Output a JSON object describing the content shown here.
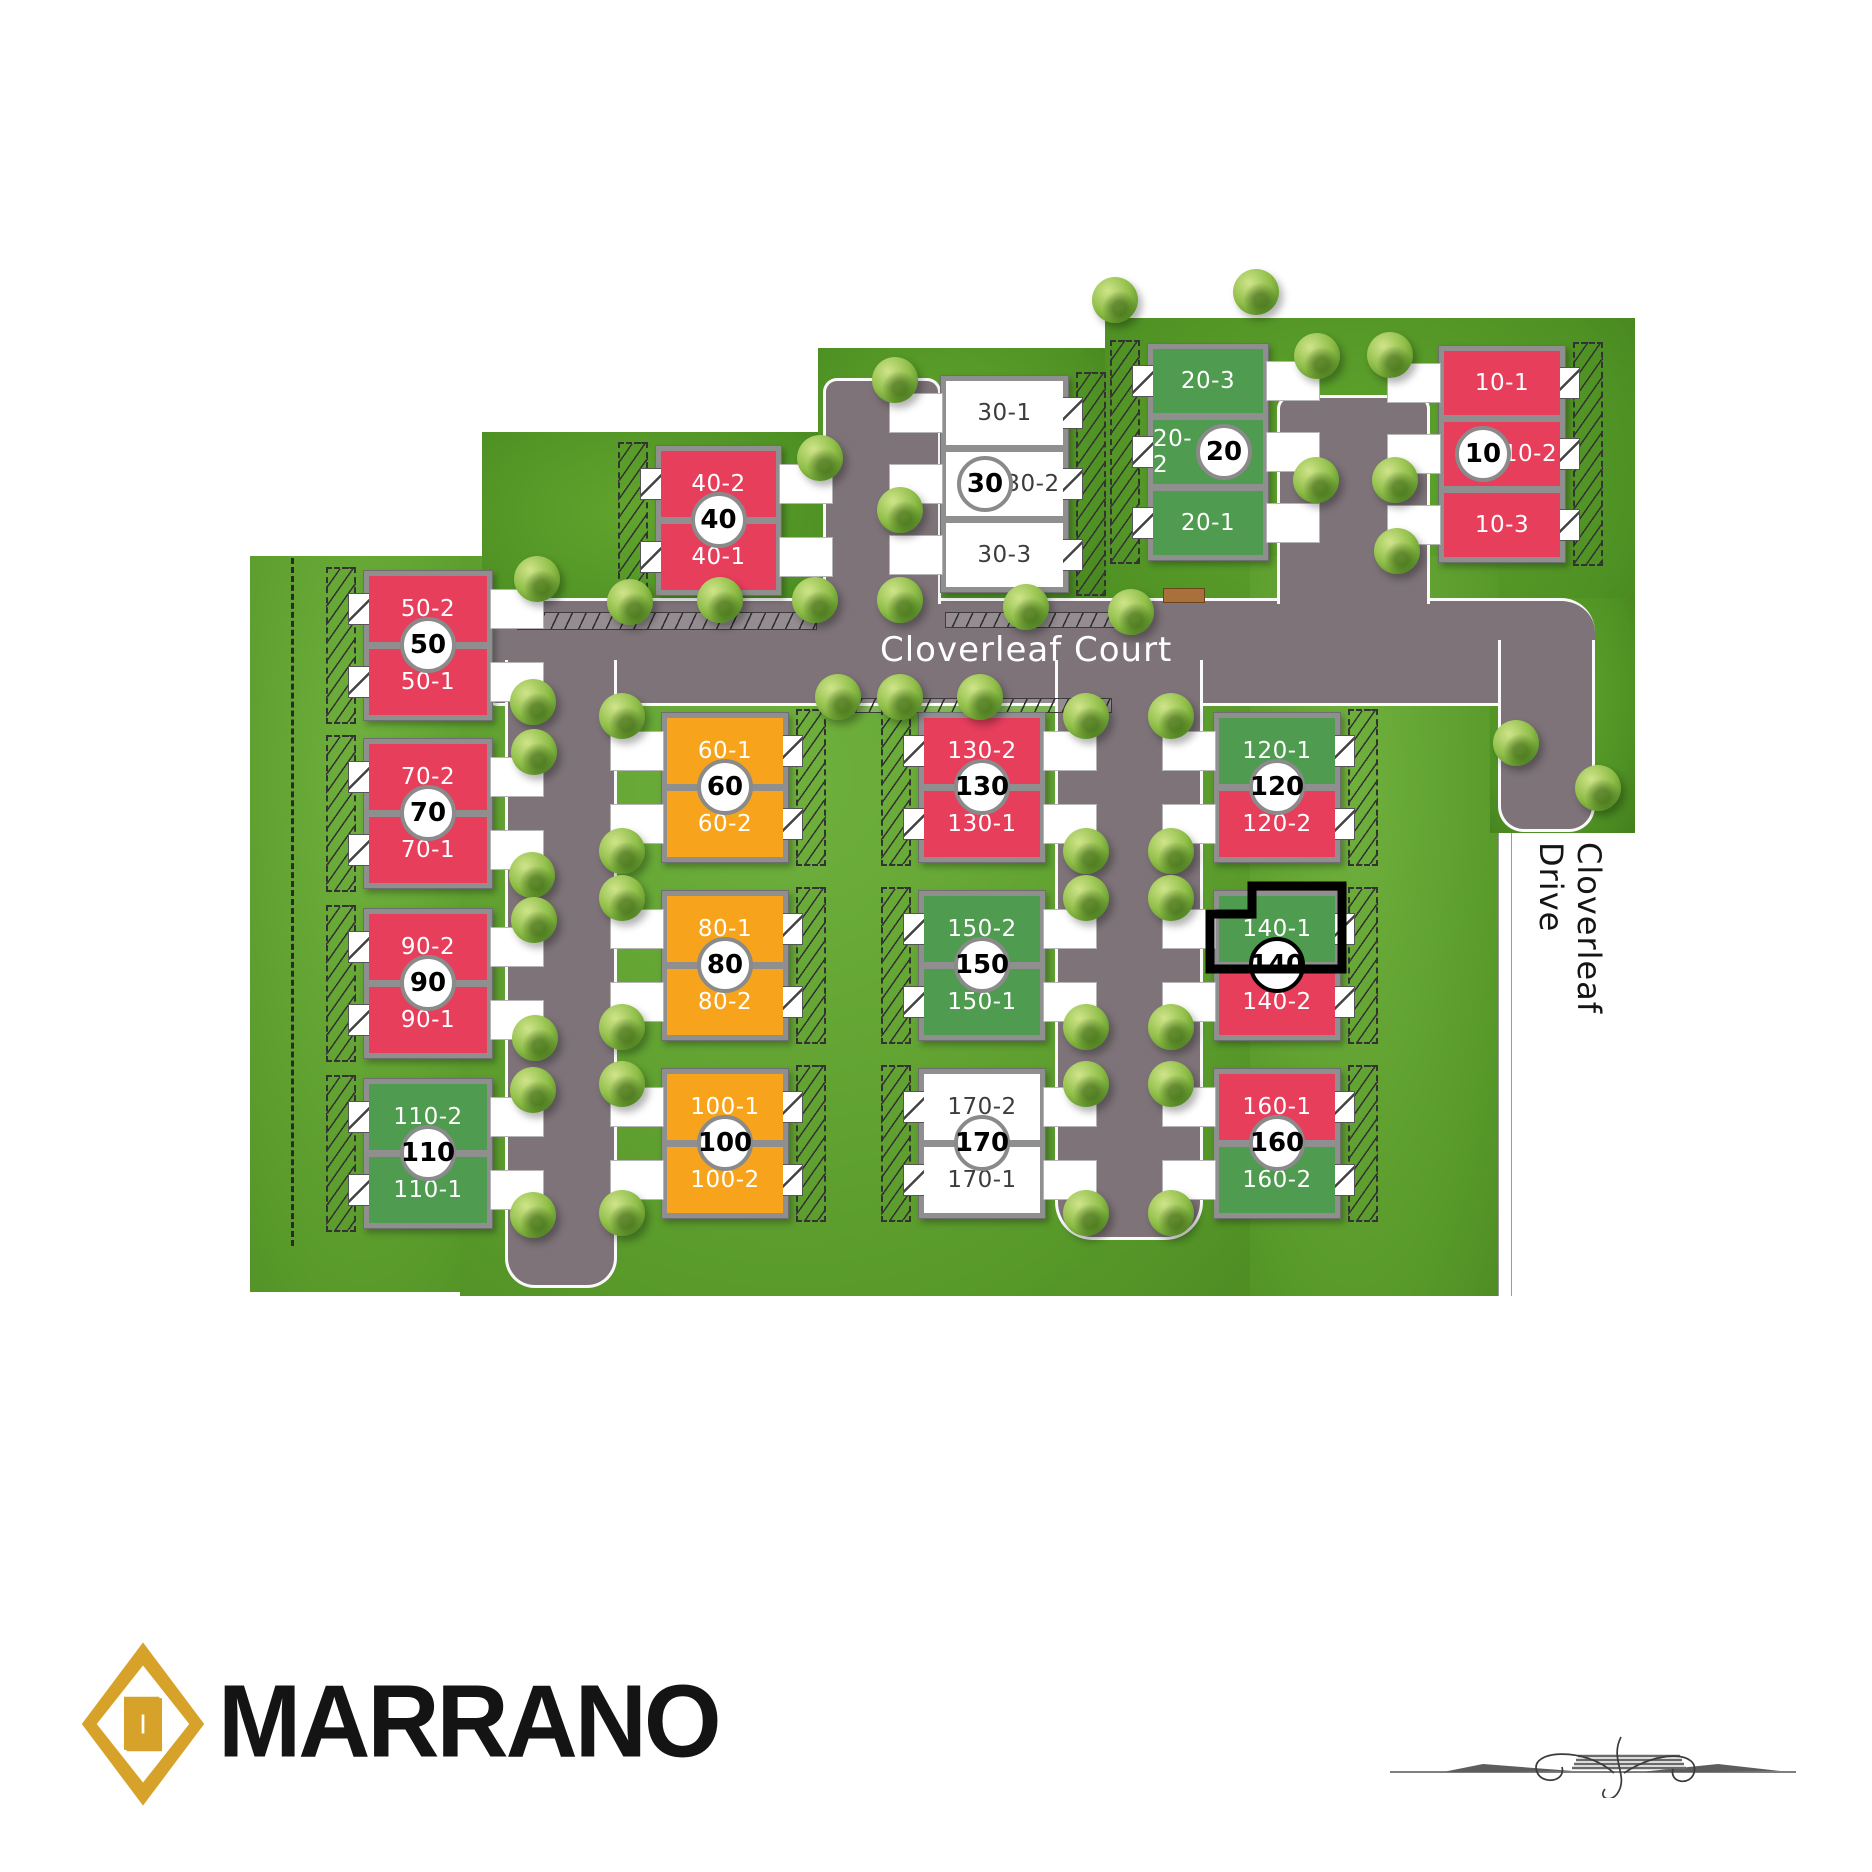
{
  "site": {
    "streets": {
      "court": "Cloverleaf Court",
      "drive": "Cloverleaf Drive"
    },
    "brand": {
      "wordmark": "MARRANO"
    },
    "highlighted_unit": "140-1",
    "colors": {
      "red": "#e73e5c",
      "green": "#4f9b4f",
      "orange": "#f7a41c",
      "white": "#ffffff",
      "road": "#7d7378",
      "grass": "#63a532",
      "brand_gold": "#d7a229"
    }
  },
  "buildings": [
    {
      "id": "10",
      "badge": "10",
      "x": 1438,
      "y": 345,
      "w": 126,
      "uh": 64,
      "garage": "W",
      "badge_side": "left",
      "units": [
        {
          "label": "10-1",
          "color": "red"
        },
        {
          "label": "10-2",
          "color": "red"
        },
        {
          "label": "10-3",
          "color": "red"
        }
      ]
    },
    {
      "id": "20",
      "badge": "20",
      "x": 1147,
      "y": 343,
      "w": 120,
      "uh": 64,
      "garage": "E",
      "badge_side": "right",
      "units": [
        {
          "label": "20-3",
          "color": "green"
        },
        {
          "label": "20-2",
          "color": "green"
        },
        {
          "label": "20-1",
          "color": "green"
        }
      ]
    },
    {
      "id": "30",
      "badge": "30",
      "x": 940,
      "y": 375,
      "w": 127,
      "uh": 64,
      "garage": "W",
      "badge_side": "left",
      "units": [
        {
          "label": "30-1",
          "color": "white"
        },
        {
          "label": "30-2",
          "color": "white"
        },
        {
          "label": "30-3",
          "color": "white"
        }
      ]
    },
    {
      "id": "40",
      "badge": "40",
      "x": 655,
      "y": 445,
      "w": 125,
      "uh": 66,
      "garage": "E",
      "units": [
        {
          "label": "40-2",
          "color": "red"
        },
        {
          "label": "40-1",
          "color": "red"
        }
      ]
    },
    {
      "id": "50",
      "badge": "50",
      "x": 363,
      "y": 570,
      "w": 128,
      "uh": 66,
      "garage": "E",
      "units": [
        {
          "label": "50-2",
          "color": "red"
        },
        {
          "label": "50-1",
          "color": "red"
        }
      ]
    },
    {
      "id": "60",
      "badge": "60",
      "x": 661,
      "y": 712,
      "w": 126,
      "uh": 66,
      "garage": "W",
      "units": [
        {
          "label": "60-1",
          "color": "orange"
        },
        {
          "label": "60-2",
          "color": "orange"
        }
      ]
    },
    {
      "id": "70",
      "badge": "70",
      "x": 363,
      "y": 738,
      "w": 128,
      "uh": 66,
      "garage": "E",
      "units": [
        {
          "label": "70-2",
          "color": "red"
        },
        {
          "label": "70-1",
          "color": "red"
        }
      ]
    },
    {
      "id": "80",
      "badge": "80",
      "x": 661,
      "y": 890,
      "w": 126,
      "uh": 66,
      "garage": "W",
      "units": [
        {
          "label": "80-1",
          "color": "orange"
        },
        {
          "label": "80-2",
          "color": "orange"
        }
      ]
    },
    {
      "id": "90",
      "badge": "90",
      "x": 363,
      "y": 908,
      "w": 128,
      "uh": 66,
      "garage": "E",
      "units": [
        {
          "label": "90-2",
          "color": "red"
        },
        {
          "label": "90-1",
          "color": "red"
        }
      ]
    },
    {
      "id": "100",
      "badge": "100",
      "x": 661,
      "y": 1068,
      "w": 126,
      "uh": 66,
      "garage": "W",
      "units": [
        {
          "label": "100-1",
          "color": "orange"
        },
        {
          "label": "100-2",
          "color": "orange"
        }
      ]
    },
    {
      "id": "110",
      "badge": "110",
      "x": 363,
      "y": 1078,
      "w": 128,
      "uh": 66,
      "garage": "E",
      "units": [
        {
          "label": "110-2",
          "color": "green"
        },
        {
          "label": "110-1",
          "color": "green"
        }
      ]
    },
    {
      "id": "120",
      "badge": "120",
      "x": 1213,
      "y": 712,
      "w": 126,
      "uh": 66,
      "garage": "W",
      "units": [
        {
          "label": "120-1",
          "color": "green"
        },
        {
          "label": "120-2",
          "color": "red"
        }
      ]
    },
    {
      "id": "130",
      "badge": "130",
      "x": 918,
      "y": 712,
      "w": 126,
      "uh": 66,
      "garage": "E",
      "units": [
        {
          "label": "130-2",
          "color": "red"
        },
        {
          "label": "130-1",
          "color": "red"
        }
      ]
    },
    {
      "id": "140",
      "badge": "140",
      "x": 1213,
      "y": 890,
      "w": 126,
      "uh": 66,
      "garage": "W",
      "units": [
        {
          "label": "140-1",
          "color": "green",
          "highlight": true
        },
        {
          "label": "140-2",
          "color": "red"
        }
      ]
    },
    {
      "id": "150",
      "badge": "150",
      "x": 918,
      "y": 890,
      "w": 126,
      "uh": 66,
      "garage": "E",
      "units": [
        {
          "label": "150-2",
          "color": "green"
        },
        {
          "label": "150-1",
          "color": "green"
        }
      ]
    },
    {
      "id": "160",
      "badge": "160",
      "x": 1213,
      "y": 1068,
      "w": 126,
      "uh": 66,
      "garage": "W",
      "units": [
        {
          "label": "160-1",
          "color": "red"
        },
        {
          "label": "160-2",
          "color": "green"
        }
      ]
    },
    {
      "id": "170",
      "badge": "170",
      "x": 918,
      "y": 1068,
      "w": 126,
      "uh": 66,
      "garage": "E",
      "units": [
        {
          "label": "170-2",
          "color": "white"
        },
        {
          "label": "170-1",
          "color": "white"
        }
      ]
    }
  ],
  "trees": [
    [
      537,
      579
    ],
    [
      533,
      702
    ],
    [
      534,
      752
    ],
    [
      532,
      875
    ],
    [
      534,
      920
    ],
    [
      535,
      1038
    ],
    [
      533,
      1090
    ],
    [
      533,
      1215
    ],
    [
      622,
      716
    ],
    [
      622,
      851
    ],
    [
      622,
      898
    ],
    [
      622,
      1027
    ],
    [
      622,
      1084
    ],
    [
      622,
      1213
    ],
    [
      1086,
      716
    ],
    [
      1171,
      716
    ],
    [
      1086,
      851
    ],
    [
      1171,
      851
    ],
    [
      1086,
      898
    ],
    [
      1171,
      898
    ],
    [
      1086,
      1027
    ],
    [
      1171,
      1027
    ],
    [
      1086,
      1084
    ],
    [
      1171,
      1084
    ],
    [
      1086,
      1213
    ],
    [
      1171,
      1213
    ],
    [
      820,
      458
    ],
    [
      630,
      602
    ],
    [
      720,
      600
    ],
    [
      815,
      600
    ],
    [
      900,
      600
    ],
    [
      1026,
      607
    ],
    [
      1131,
      612
    ],
    [
      838,
      697
    ],
    [
      900,
      697
    ],
    [
      980,
      697
    ],
    [
      895,
      380
    ],
    [
      900,
      510
    ],
    [
      1115,
      300
    ],
    [
      1256,
      292
    ],
    [
      1317,
      356
    ],
    [
      1316,
      480
    ],
    [
      1390,
      355
    ],
    [
      1395,
      480
    ],
    [
      1397,
      551
    ],
    [
      1516,
      743
    ],
    [
      1598,
      788
    ]
  ]
}
